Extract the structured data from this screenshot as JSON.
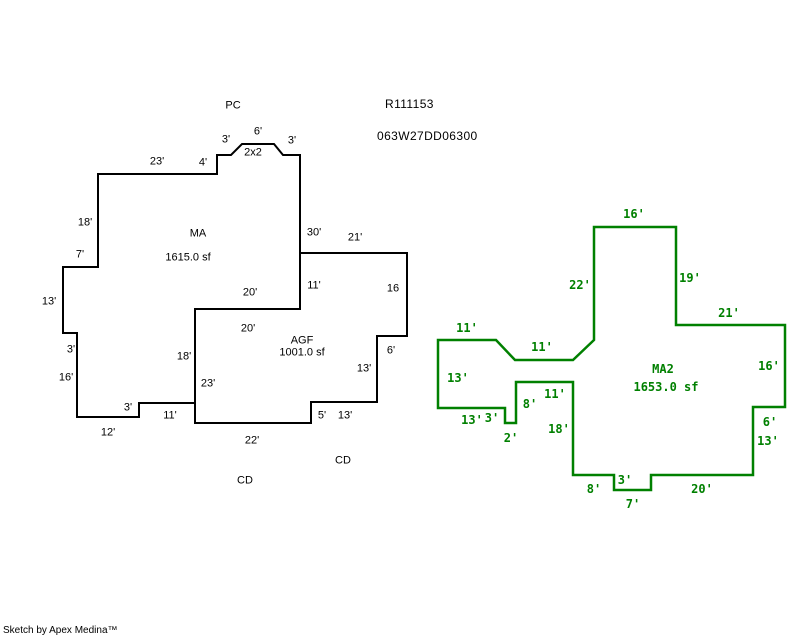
{
  "page": {
    "background": "#ffffff",
    "refs": {
      "ref1": "R111153",
      "ref2": "063W27DD06300"
    },
    "credit": "Sketch by Apex Medina™"
  },
  "colors": {
    "primary_outline": "#000000",
    "secondary_outline": "#008000"
  },
  "site_annotations": [
    {
      "text": "PC",
      "x": 233,
      "y": 106
    },
    {
      "text": "CD",
      "x": 245,
      "y": 481
    },
    {
      "text": "CD",
      "x": 343,
      "y": 461
    }
  ],
  "polygons": [
    {
      "id": "ma",
      "label": "MA",
      "area": "1615.0 sf",
      "style": "black",
      "color": "#000000",
      "stroke_width": 2,
      "label_pos": {
        "x": 198,
        "y": 234
      },
      "area_pos": {
        "x": 188,
        "y": 258
      },
      "points": [
        [
          98,
          174
        ],
        [
          217,
          174
        ],
        [
          217,
          155
        ],
        [
          231,
          155
        ],
        [
          242,
          144
        ],
        [
          274,
          144
        ],
        [
          283,
          155
        ],
        [
          300,
          155
        ],
        [
          300,
          309
        ],
        [
          195,
          309
        ],
        [
          195,
          403
        ],
        [
          139,
          403
        ],
        [
          139,
          417
        ],
        [
          77,
          417
        ],
        [
          77,
          333
        ],
        [
          63,
          333
        ],
        [
          63,
          267
        ],
        [
          98,
          267
        ]
      ],
      "dimensions": [
        {
          "text": "23'",
          "x": 157,
          "y": 162
        },
        {
          "text": "4'",
          "x": 203,
          "y": 163
        },
        {
          "text": "3'",
          "x": 226,
          "y": 140
        },
        {
          "text": "6'",
          "x": 258,
          "y": 132
        },
        {
          "text": "2x2",
          "x": 253,
          "y": 153
        },
        {
          "text": "3'",
          "x": 292,
          "y": 141
        },
        {
          "text": "30'",
          "x": 314,
          "y": 233
        },
        {
          "text": "20'",
          "x": 250,
          "y": 293
        },
        {
          "text": "18'",
          "x": 184,
          "y": 357
        },
        {
          "text": "11'",
          "x": 170,
          "y": 416
        },
        {
          "text": "3'",
          "x": 128,
          "y": 408
        },
        {
          "text": "12'",
          "x": 108,
          "y": 433
        },
        {
          "text": "16'",
          "x": 66,
          "y": 378
        },
        {
          "text": "3'",
          "x": 71,
          "y": 350
        },
        {
          "text": "13'",
          "x": 49,
          "y": 302
        },
        {
          "text": "7'",
          "x": 80,
          "y": 255
        },
        {
          "text": "18'",
          "x": 85,
          "y": 223
        }
      ]
    },
    {
      "id": "agf",
      "label": "AGF",
      "area": "1001.0 sf",
      "style": "black",
      "color": "#000000",
      "stroke_width": 2,
      "label_pos": {
        "x": 302,
        "y": 341
      },
      "area_pos": {
        "x": 302,
        "y": 353
      },
      "points": [
        [
          300,
          253
        ],
        [
          407,
          253
        ],
        [
          407,
          336
        ],
        [
          377,
          336
        ],
        [
          377,
          402
        ],
        [
          311,
          402
        ],
        [
          311,
          423
        ],
        [
          195,
          423
        ],
        [
          195,
          309
        ],
        [
          300,
          309
        ]
      ],
      "dimensions": [
        {
          "text": "21'",
          "x": 355,
          "y": 238
        },
        {
          "text": "11'",
          "x": 314,
          "y": 286
        },
        {
          "text": "16",
          "x": 393,
          "y": 289
        },
        {
          "text": "6'",
          "x": 391,
          "y": 351
        },
        {
          "text": "13'",
          "x": 364,
          "y": 369
        },
        {
          "text": "13'",
          "x": 345,
          "y": 416
        },
        {
          "text": "5'",
          "x": 322,
          "y": 416
        },
        {
          "text": "22'",
          "x": 252,
          "y": 441
        },
        {
          "text": "23'",
          "x": 208,
          "y": 384
        },
        {
          "text": "20'",
          "x": 248,
          "y": 329
        }
      ]
    },
    {
      "id": "ma2",
      "label": "MA2",
      "area": "1653.0 sf",
      "style": "green",
      "color": "#008000",
      "stroke_width": 2.5,
      "label_pos": {
        "x": 663,
        "y": 369
      },
      "area_pos": {
        "x": 666,
        "y": 387
      },
      "points": [
        [
          594,
          227
        ],
        [
          676,
          227
        ],
        [
          676,
          325
        ],
        [
          785,
          325
        ],
        [
          785,
          407
        ],
        [
          753,
          407
        ],
        [
          753,
          475
        ],
        [
          651,
          475
        ],
        [
          651,
          490
        ],
        [
          614,
          490
        ],
        [
          614,
          475
        ],
        [
          573,
          475
        ],
        [
          573,
          382
        ],
        [
          516,
          382
        ],
        [
          516,
          423
        ],
        [
          505,
          423
        ],
        [
          505,
          408
        ],
        [
          438,
          408
        ],
        [
          438,
          340
        ],
        [
          496,
          340
        ],
        [
          515,
          360
        ],
        [
          573,
          360
        ],
        [
          594,
          340
        ]
      ],
      "dimensions": [
        {
          "text": "16'",
          "x": 634,
          "y": 214
        },
        {
          "text": "22'",
          "x": 580,
          "y": 285
        },
        {
          "text": "19'",
          "x": 690,
          "y": 278
        },
        {
          "text": "21'",
          "x": 729,
          "y": 313
        },
        {
          "text": "16'",
          "x": 769,
          "y": 366
        },
        {
          "text": "6'",
          "x": 770,
          "y": 422
        },
        {
          "text": "13'",
          "x": 768,
          "y": 441
        },
        {
          "text": "20'",
          "x": 702,
          "y": 489
        },
        {
          "text": "7'",
          "x": 633,
          "y": 504
        },
        {
          "text": "3'",
          "x": 625,
          "y": 480
        },
        {
          "text": "8'",
          "x": 594,
          "y": 489
        },
        {
          "text": "18'",
          "x": 559,
          "y": 429
        },
        {
          "text": "11'",
          "x": 555,
          "y": 394
        },
        {
          "text": "8'",
          "x": 530,
          "y": 404
        },
        {
          "text": "2'",
          "x": 511,
          "y": 438
        },
        {
          "text": "3'",
          "x": 492,
          "y": 418
        },
        {
          "text": "13'",
          "x": 472,
          "y": 420
        },
        {
          "text": "13'",
          "x": 458,
          "y": 378
        },
        {
          "text": "11'",
          "x": 467,
          "y": 328
        },
        {
          "text": "11'",
          "x": 542,
          "y": 347
        }
      ]
    }
  ]
}
